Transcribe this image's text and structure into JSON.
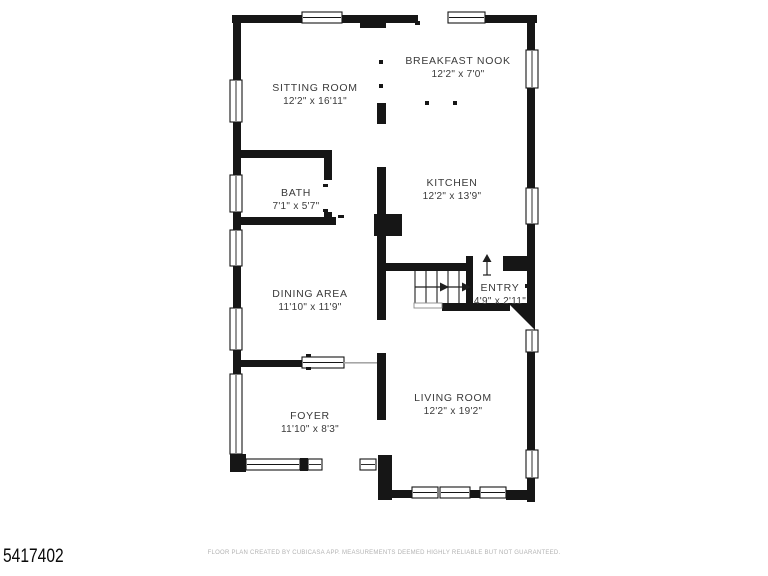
{
  "title": "Floor plan",
  "colors": {
    "wall": "#161616",
    "label_text": "#3a3a3a",
    "footer_text": "#b3b3b3",
    "listing_id_text": "#0a0a0a",
    "background": "#ffffff"
  },
  "rooms": [
    {
      "id": "sitting-room",
      "name": "SITTING ROOM",
      "dims": "12'2\" x 16'11\""
    },
    {
      "id": "breakfast-nook",
      "name": "BREAKFAST NOOK",
      "dims": "12'2\" x 7'0\""
    },
    {
      "id": "bath",
      "name": "BATH",
      "dims": "7'1\" x 5'7\""
    },
    {
      "id": "kitchen",
      "name": "KITCHEN",
      "dims": "12'2\" x 13'9\""
    },
    {
      "id": "dining-area",
      "name": "DINING AREA",
      "dims": "11'10\" x 11'9\""
    },
    {
      "id": "entry",
      "name": "ENTRY",
      "dims": "4'9\" x 2'11\""
    },
    {
      "id": "foyer",
      "name": "FOYER",
      "dims": "11'10\" x 8'3\""
    },
    {
      "id": "living-room",
      "name": "LIVING ROOM",
      "dims": "12'2\" x 19'2\""
    }
  ],
  "symbols": {
    "stairs": "stairs-icon",
    "stairs_direction": "right-arrow-icon",
    "entry_direction": "up-arrow-icon",
    "entry_door": "angled-door-icon",
    "windows": "window-symbol"
  },
  "footer": {
    "disclaimer": "FLOOR PLAN CREATED BY CUBICASA APP. MEASUREMENTS DEEMED HIGHLY RELIABLE BUT NOT GUARANTEED."
  },
  "listing_id": "5417402"
}
